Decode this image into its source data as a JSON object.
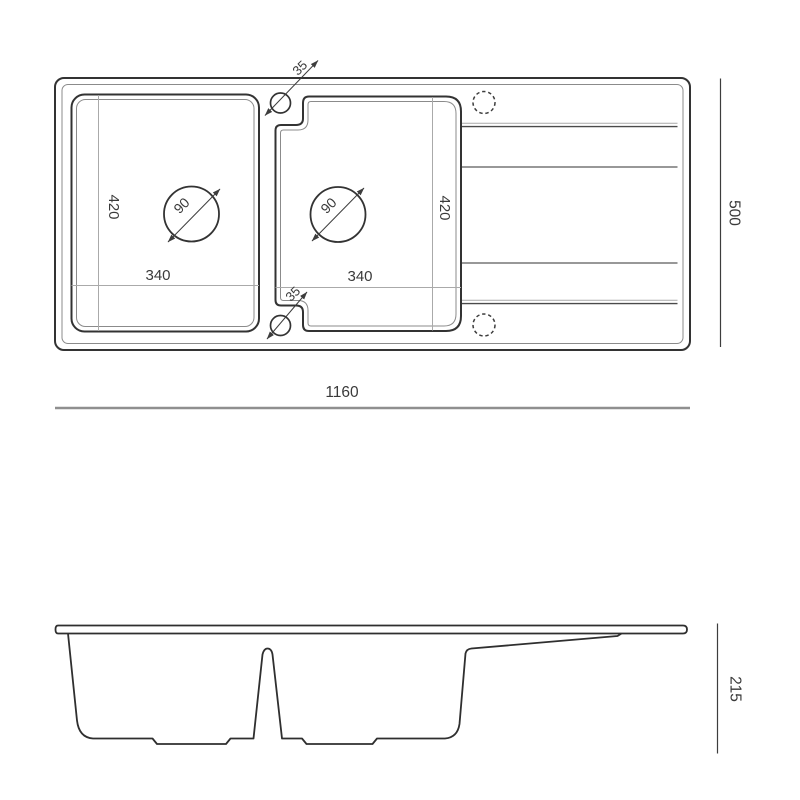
{
  "drawing_title": "kitchen-sink-technical-drawing",
  "colors": {
    "outline": "#333333",
    "secondary": "#888888",
    "reference": "#aaaaaa",
    "dimension_line": "#8f8f8f",
    "text": "#3a3a3a"
  },
  "top_view": {
    "overall_width_mm": "1160",
    "overall_depth_mm": "500",
    "bowls": [
      {
        "width_mm": "340",
        "depth_mm": "420",
        "drain_diameter_mm": "90"
      },
      {
        "width_mm": "340",
        "depth_mm": "420",
        "drain_diameter_mm": "90"
      }
    ],
    "tap_holes": [
      {
        "diameter_mm": "35"
      },
      {
        "diameter_mm": "35"
      }
    ]
  },
  "side_view": {
    "depth_mm": "215"
  }
}
